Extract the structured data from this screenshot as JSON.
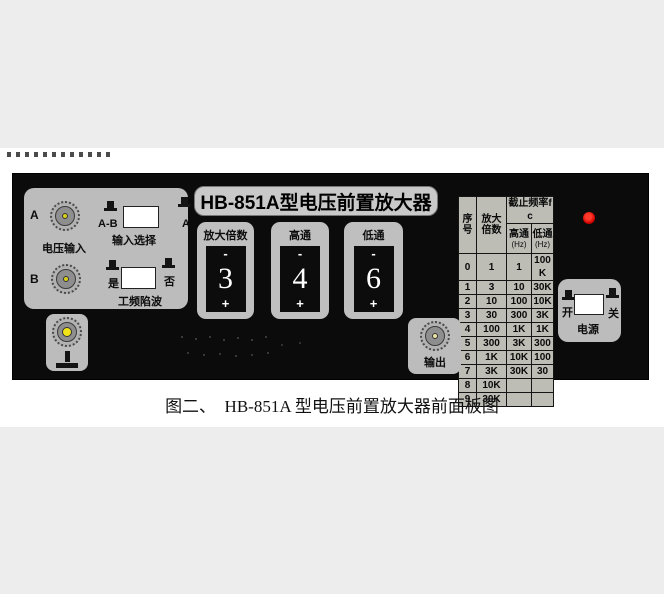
{
  "figure": {
    "caption": "图二、  HB-851A 型电压前置放大器前面板图"
  },
  "panel": {
    "title": "HB-851A型电压前置放大器",
    "input": {
      "a": "A",
      "b": "B",
      "voltage_input": "电压输入",
      "input_select": "输入选择",
      "sel_left": "A-B",
      "sel_right": "A",
      "notch_yes": "是",
      "notch_no": "否",
      "notch": "工频陷波"
    },
    "controls": [
      {
        "label": "放大倍数",
        "minus": "-",
        "value": "3",
        "plus": "+"
      },
      {
        "label": "高通",
        "minus": "-",
        "value": "4",
        "plus": "+"
      },
      {
        "label": "低通",
        "minus": "-",
        "value": "6",
        "plus": "+"
      }
    ],
    "output": {
      "label": "输出"
    },
    "power": {
      "on": "开",
      "off": "关",
      "label": "电源"
    },
    "table": {
      "seq": "序号",
      "gain": "放大倍数",
      "cutoff": "截止频率fc",
      "hp": "高通",
      "lp": "低通",
      "hz": "(Hz)",
      "rows": [
        [
          "0",
          "1",
          "1",
          "100K"
        ],
        [
          "1",
          "3",
          "10",
          "30K"
        ],
        [
          "2",
          "10",
          "100",
          "10K"
        ],
        [
          "3",
          "30",
          "300",
          "3K"
        ],
        [
          "4",
          "100",
          "1K",
          "1K"
        ],
        [
          "5",
          "300",
          "3K",
          "300"
        ],
        [
          "6",
          "1K",
          "10K",
          "100"
        ],
        [
          "7",
          "3K",
          "30K",
          "30"
        ],
        [
          "8",
          "10K",
          "",
          ""
        ],
        [
          "9",
          "30K",
          "",
          ""
        ]
      ]
    },
    "colors": {
      "led": "#e00000",
      "panel": "#0b0b0b",
      "box_gray": "#bdbdbd",
      "connector_core": "#e8d41e"
    }
  }
}
